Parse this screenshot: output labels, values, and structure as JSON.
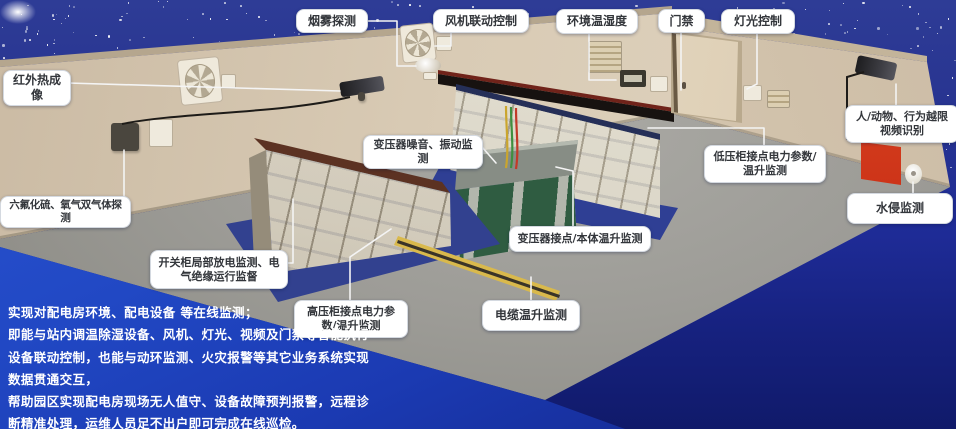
{
  "callouts": {
    "smoke": "烟雾探测",
    "fan": "风机联动控制",
    "env": "环境温湿度",
    "door": "门禁",
    "light": "灯光控制",
    "infrared": "红外热成像",
    "gas": "六氟化硫、氧气双气体探测",
    "person": "人/动物、行为越限视频识别",
    "water": "水侵监测",
    "transformer_noise": "变压器噪音、振动监测",
    "lv_cabinet": "低压柜接点电力参数/温升监测",
    "transformer_joint": "变压器接点/本体温升监测",
    "switchgear": "开关柜局部放电监测、电气绝缘运行监督",
    "hv_cabinet": "高压柜接点电力参数/温升监测",
    "cable": "电缆温升监测"
  },
  "description": {
    "lines": [
      "实现对配电房环境、配电设备 等在线监测；",
      "即能与站内调温除湿设备、风机、灯光、视频及门禁等智能执行",
      "设备联动控制，也能与动环监测、火灾报警等其它业务系统实现",
      "数据贯通交互，",
      "帮助园区实现配电房现场无人值守、设备故障预判报警，远程诊",
      "断精准处理，运维人员足不出户即可完成在线巡检。"
    ]
  },
  "colors": {
    "sky_blue": "#2e3c96",
    "panel_blue": "#2148c4",
    "wall_beige": "#d8cab4",
    "floor_gray": "#9d9c97",
    "mat_blue": "#32418f",
    "cabinet_green": "#2f5c41",
    "tray_yellow": "#d9b94c",
    "alert_red": "#cc3318",
    "label_bg": "#ffffff",
    "label_text": "#33363b"
  }
}
